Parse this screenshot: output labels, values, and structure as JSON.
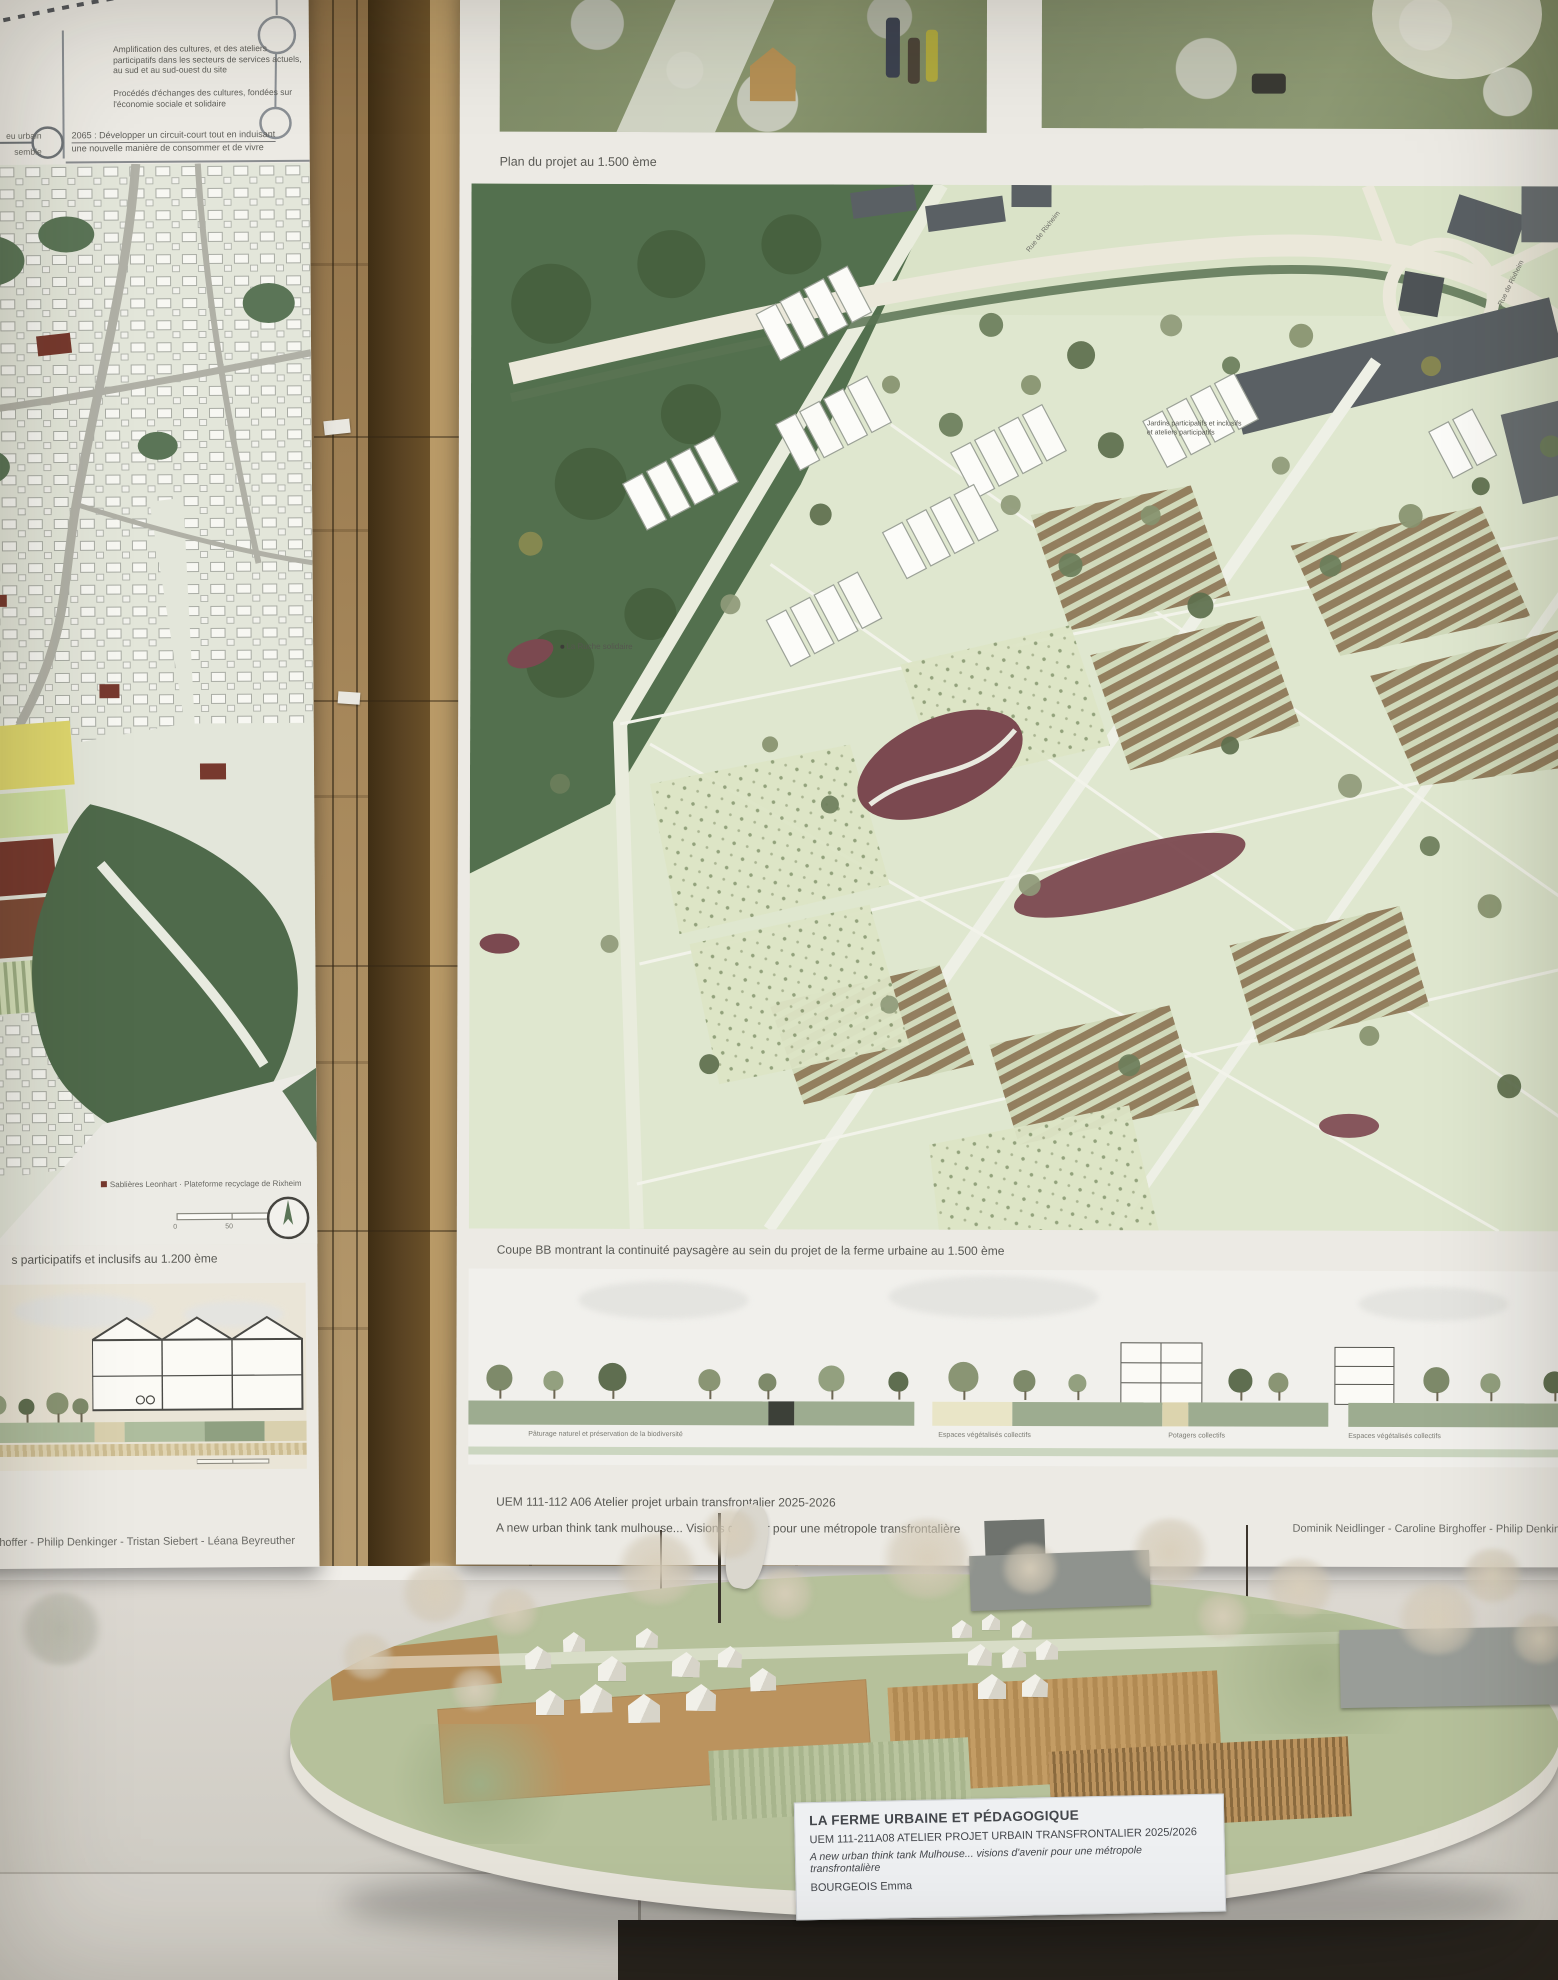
{
  "left_poster": {
    "diagram": {
      "note1": "Amplification des cultures, et des ateliers participatifs dans les secteurs de services actuels, au sud et au sud-ouest du site",
      "note2": "Procédés d'échanges des cultures, fondées sur l'économie sociale et solidaire",
      "milestone_line1": "2065 : Développer un circuit-court tout en induisant",
      "milestone_line2": "une nouvelle manière de consommer et de vivre",
      "edge_label_top": "eu urbain",
      "edge_label_bottom": "semble"
    },
    "map": {
      "site_label": "Sablières Leonhart · Plateforme recyclage de Rixheim",
      "scale_ticks": [
        "0",
        "50",
        "100m"
      ]
    },
    "caption": "s participatifs et inclusifs au 1.200 ème",
    "credits": "Birghoffer - Philip Denkinger - Tristan Siebert - Léana Beyreuther"
  },
  "right_poster": {
    "plan_caption": "Plan du projet au 1.500 ème",
    "plan_labels": {
      "ruche": "La Ruche solidaire",
      "jardins_line1": "Jardins participatifs et inclusifs",
      "jardins_line2": "et ateliers participatifs",
      "road": "Rue de Rixheim"
    },
    "coupe_caption": "Coupe BB montrant la continuité paysagère au sein du projet de la ferme urbaine au 1.500 ème",
    "section_labels": [
      "Pâturage naturel et préservation de la biodiversité",
      "Espaces végétalisés collectifs",
      "Potagers collectifs",
      "Espaces végétalisés collectifs"
    ],
    "footer": {
      "line1": "UEM 111-112 A06 Atelier projet urbain transfrontalier 2025-2026",
      "line2": "A new urban think tank mulhouse... Visions d'avenir pour une métropole transfrontalière",
      "credits": "Dominik Neidlinger - Caroline Birghoffer - Philip Denkinger"
    }
  },
  "model": {
    "label": {
      "title": "LA FERME URBAINE ET PÉDAGOGIQUE",
      "line1": "UEM 111-211A08 ATELIER PROJET URBAIN TRANSFRONTALIER 2025/2026",
      "line2": "A new urban think tank Mulhouse... visions d'avenir pour une métropole transfrontalière",
      "line3": "BOURGEOIS Emma"
    }
  },
  "colors": {
    "wall": "#a5854f",
    "poster": "#eceae4",
    "forest": "#54714f",
    "farmland": "#dfe7cf",
    "pond": "#7b4950",
    "model_green": "#b6c19b"
  }
}
